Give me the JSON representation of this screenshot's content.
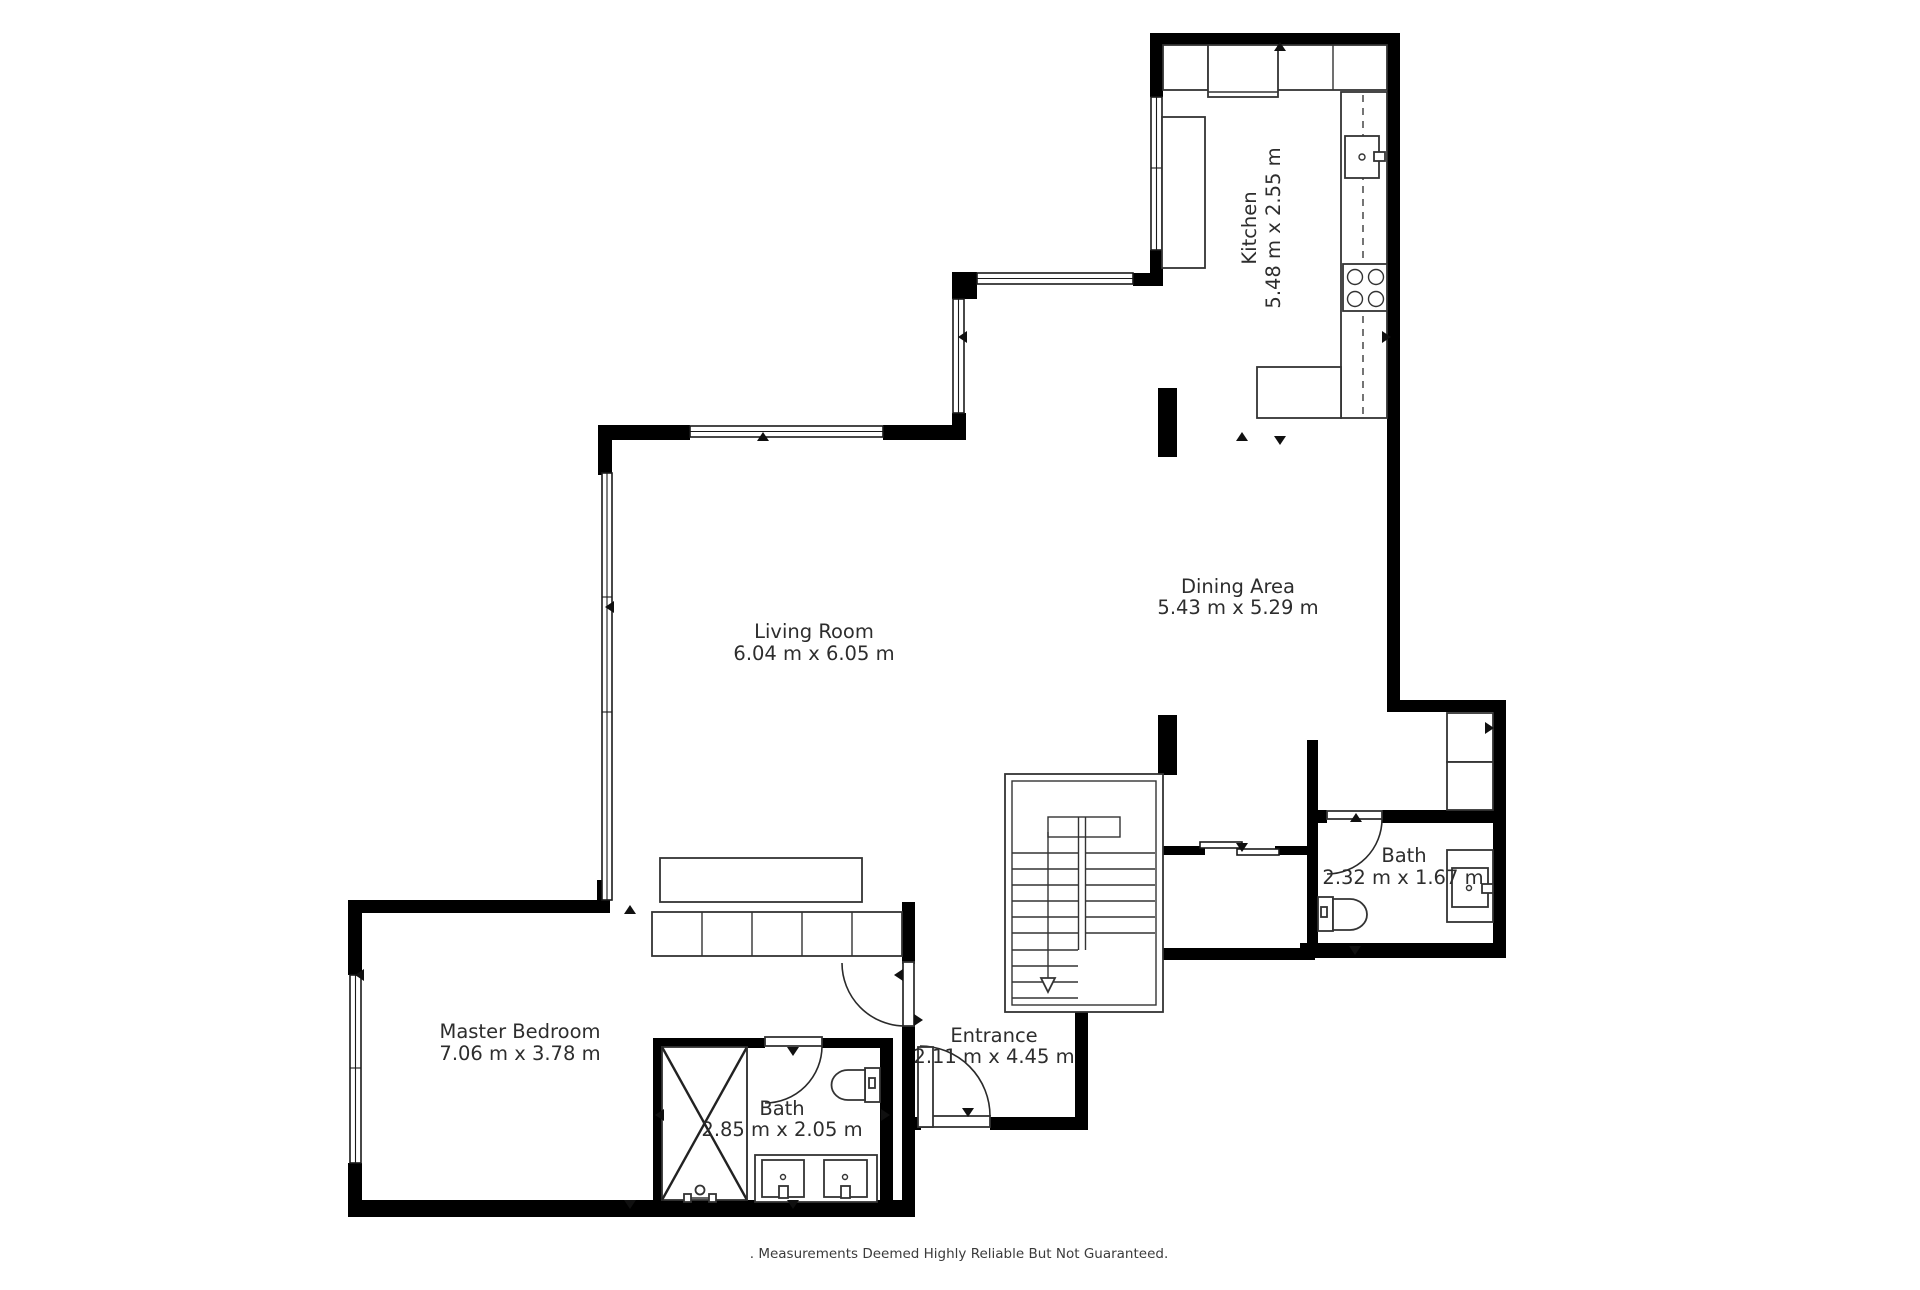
{
  "plan_title": "Apartment Floor Plan",
  "rooms": {
    "kitchen": {
      "name": "Kitchen",
      "dims": "5.48 m x 2.55 m"
    },
    "dining": {
      "name": "Dining Area",
      "dims": "5.43 m x 5.29 m"
    },
    "living": {
      "name": "Living Room",
      "dims": "6.04 m x 6.05 m"
    },
    "master": {
      "name": "Master Bedroom",
      "dims": "7.06 m x 3.78 m"
    },
    "bath_right": {
      "name": "Bath",
      "dims": "2.32 m x 1.67 m"
    },
    "bath_master": {
      "name": "Bath",
      "dims": "2.85 m x 2.05 m"
    },
    "entrance": {
      "name": "Entrance",
      "dims": "2.11 m x 4.45 m"
    }
  },
  "disclaimer": ". Measurements Deemed Highly Reliable But Not Guaranteed.",
  "fixtures": [
    "stairs",
    "stove",
    "kitchen-sink",
    "counter",
    "shower",
    "toilet",
    "double-sink-vanity",
    "single-sink-vanity",
    "sofa",
    "closet",
    "sliding-door",
    "hinged-door",
    "window"
  ],
  "colors": {
    "wall": "#000000",
    "line": "#333333",
    "text": "#2d2d2d",
    "background": "#ffffff"
  }
}
